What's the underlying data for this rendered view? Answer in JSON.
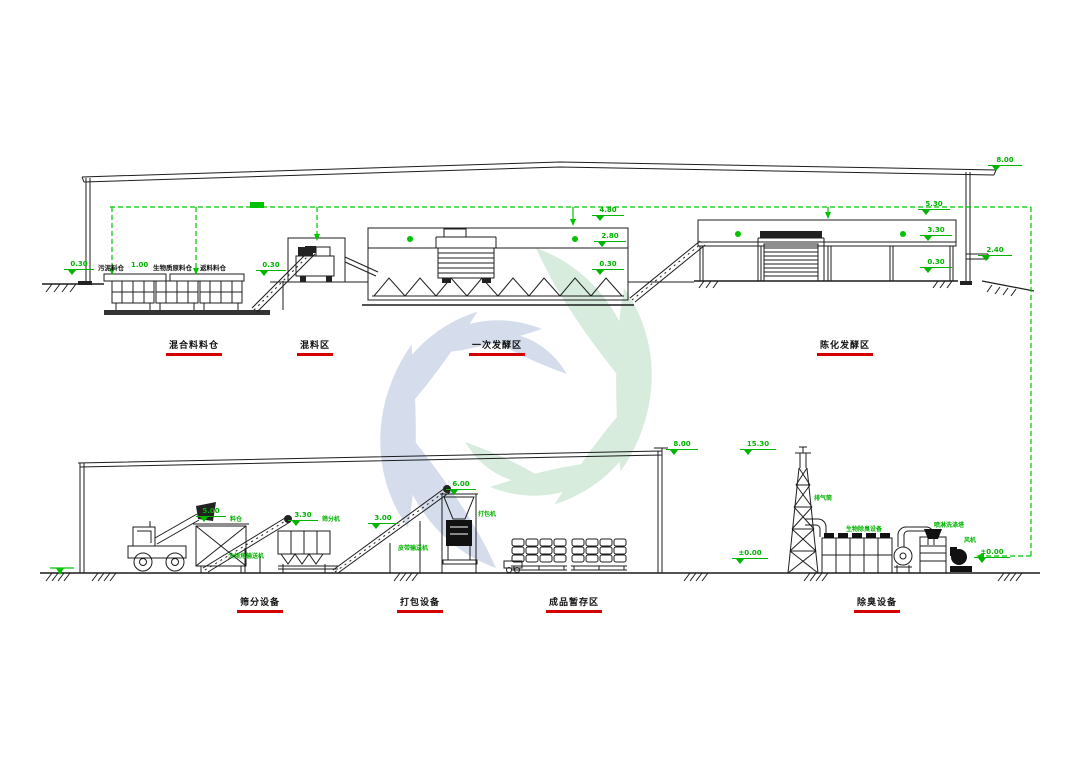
{
  "colors": {
    "line": "#1c1c1c",
    "annotation_green": "#00b400",
    "label_red": "#d40000",
    "watermark_blue": "#b4c3e0",
    "watermark_green": "#b7ddc3"
  },
  "top_elevation": {
    "zones": [
      {
        "label": "混合料料仓"
      },
      {
        "label": "混料区"
      },
      {
        "label": "一次发酵区"
      },
      {
        "label": "陈化发酵区"
      }
    ],
    "silos": [
      "污泥料仓",
      "生物质原料仓",
      "返料料仓"
    ],
    "dims": {
      "ground_left": "0.30",
      "silo_gap": "1.00",
      "mixer_base": "0.30",
      "ferm_wall_top": "4.80",
      "ferm_mid": "2.80",
      "ferm_base": "0.30",
      "aging_wall_top": "5.30",
      "aging_mid": "3.30",
      "aging_base": "0.30",
      "roof_eave": "8.00",
      "right_wall": "2.40"
    }
  },
  "bottom_elevation": {
    "zones": [
      {
        "label": "筛分设备"
      },
      {
        "label": "打包设备"
      },
      {
        "label": "成品暂存区"
      },
      {
        "label": "除臭设备"
      }
    ],
    "equipment": {
      "hopper": "料仓",
      "incline_conveyor": "大倾角输送机",
      "screener": "筛分机",
      "belt_conveyor": "皮带输送机",
      "packer": "打包机",
      "exhaust_stack": "排气筒",
      "biofilter": "生物除臭设备",
      "scrubber": "喷淋洗涤塔",
      "fan": "风机"
    },
    "dims": {
      "roof_eave": "8.00",
      "stack_top": "15.30",
      "hopper_top": "5.00",
      "screener_top": "3.30",
      "conveyor_top": "3.00",
      "packer_top": "6.00",
      "ground_left": "±0.00",
      "ground_right": "±0.00"
    }
  }
}
